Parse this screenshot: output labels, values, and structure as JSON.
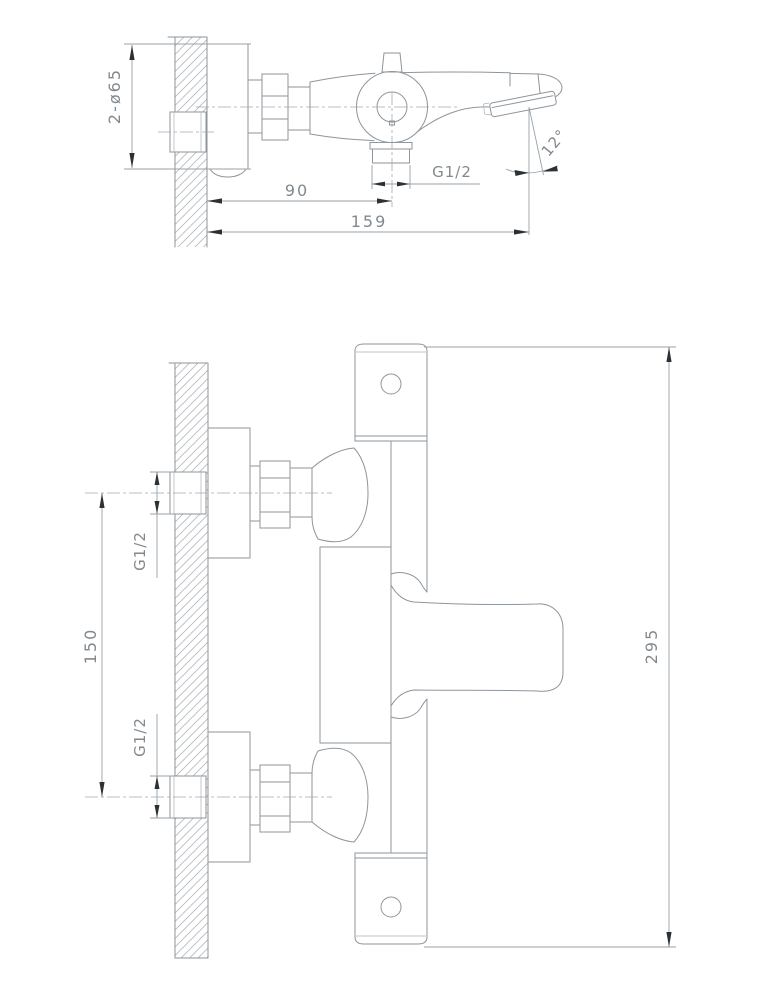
{
  "drawing": {
    "side_view": {
      "labels": {
        "flange_diameter": "2-ø65",
        "wall_to_outlet": "90",
        "wall_to_spout": "159",
        "outlet_thread": "G1/2",
        "spout_angle": "12°"
      }
    },
    "front_view": {
      "labels": {
        "inlet_top_thread": "G1/2",
        "inlet_spacing": "150",
        "inlet_bottom_thread": "G1/2",
        "overall_length": "295"
      }
    },
    "colors": {
      "background": "#ffffff",
      "outline": "#8e959b",
      "dimension_line": "#9aa1a6",
      "text": "#82898e",
      "arrow": "#2c3135",
      "hatch": "#b4b9bd"
    }
  }
}
